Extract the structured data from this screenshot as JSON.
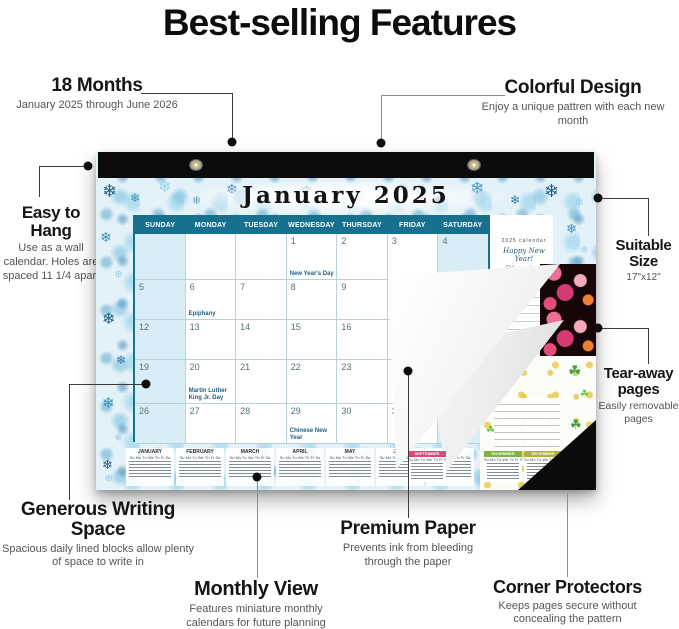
{
  "title": "Best-selling Features",
  "callouts": {
    "months": {
      "heading": "18 Months",
      "sub": "January 2025 through June 2026"
    },
    "colorful": {
      "heading": "Colorful Design",
      "sub": "Enjoy a unique pattren with each new month"
    },
    "hang": {
      "heading": "Easy to Hang",
      "sub": "Use as a wall calendar. Holes are spaced 11 1/4 apart"
    },
    "size": {
      "heading": "Suitable Size",
      "sub": "17\"x12\""
    },
    "tear": {
      "heading": "Tear-away pages",
      "sub": "Easily removable pages"
    },
    "writing": {
      "heading": "Generous Writing Space",
      "sub": "Spacious daily lined blocks allow plenty of space to write in"
    },
    "monthly": {
      "heading": "Monthly View",
      "sub": "Features miniature monthly calendars for future planning"
    },
    "paper": {
      "heading": "Premium Paper",
      "sub": "Prevents ink from bleeding through the paper"
    },
    "corner": {
      "heading": "Corner Protectors",
      "sub": "Keeps pages secure without concealing the pattern"
    }
  },
  "calendar": {
    "month_title": "January 2025",
    "day_headers": [
      "SUNDAY",
      "MONDAY",
      "TUESDAY",
      "WEDNESDAY",
      "THURSDAY",
      "FRIDAY",
      "SATURDAY"
    ],
    "weeks": [
      [
        {
          "d": ""
        },
        {
          "d": ""
        },
        {
          "d": ""
        },
        {
          "d": "1",
          "h": "New Year's Day"
        },
        {
          "d": "2"
        },
        {
          "d": "3"
        },
        {
          "d": "4"
        }
      ],
      [
        {
          "d": "5"
        },
        {
          "d": "6",
          "h": "Epiphany"
        },
        {
          "d": "7"
        },
        {
          "d": "8"
        },
        {
          "d": "9"
        },
        {
          "d": "10"
        },
        {
          "d": "11"
        }
      ],
      [
        {
          "d": "12"
        },
        {
          "d": "13"
        },
        {
          "d": "14"
        },
        {
          "d": "15"
        },
        {
          "d": "16"
        },
        {
          "d": "17"
        },
        {
          "d": "18"
        }
      ],
      [
        {
          "d": "19"
        },
        {
          "d": "20",
          "h": "Martin Luther King Jr. Day"
        },
        {
          "d": "21"
        },
        {
          "d": "22"
        },
        {
          "d": "23"
        },
        {
          "d": "24"
        },
        {
          "d": "25"
        }
      ],
      [
        {
          "d": "26"
        },
        {
          "d": "27"
        },
        {
          "d": "28"
        },
        {
          "d": "29",
          "h": "Chinese New Year"
        },
        {
          "d": "30"
        },
        {
          "d": "31"
        },
        {
          "d": ""
        }
      ]
    ],
    "notes": {
      "line1": "2025 calendar",
      "line2": "Happy New Year!",
      "line3": "Blessing"
    },
    "mini_day_row": "Su Mo Tu We Th Fr Sa",
    "mini_months": [
      "JANUARY",
      "FEBRUARY",
      "MARCH",
      "APRIL",
      "MAY",
      "JUNE",
      "JULY"
    ],
    "revealed": {
      "pink_months": [
        "SEPTEMBER"
      ],
      "green_months": [
        "NOVEMBER",
        "DECEMBER"
      ]
    }
  },
  "colors": {
    "header_teal": "#17718e",
    "weekend_col": "#d9edf6",
    "mini_pink_header": "#e0457b",
    "mini_green_header": "#7cb63c",
    "mini_yellow_header": "#b0b032",
    "corner_black": "#0b0b0b"
  },
  "icons": {
    "snowflake": "❄",
    "clover": "☘"
  }
}
